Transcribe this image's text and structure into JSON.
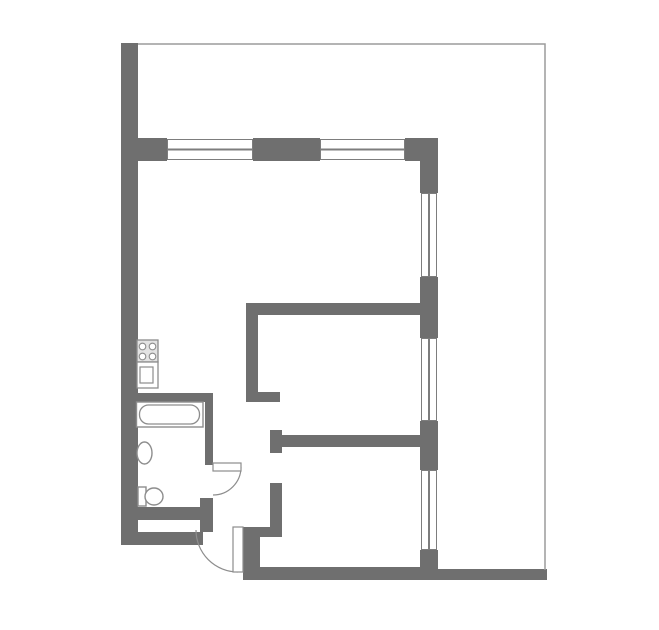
{
  "document": {
    "kind": "apartment-floor-plan",
    "title_text": ""
  },
  "canvas": {
    "width": 659,
    "height": 630
  },
  "colors": {
    "background": "#ffffff",
    "floor": "#ffffff",
    "wall": "#6f6f6f",
    "window_frame": "#7d7d7d",
    "window_line": "#7d7d7d",
    "fixture_outline": "#8d8d8d",
    "stove_fill": "#e3e3e3",
    "site_outline": "#9c9c9c"
  },
  "walls": [
    {
      "name": "wall-left",
      "x": 121,
      "y": 43,
      "w": 17,
      "h": 502
    },
    {
      "name": "wall-top-pier-left",
      "x": 138,
      "y": 138,
      "w": 29,
      "h": 23
    },
    {
      "name": "wall-top-pier-middle",
      "x": 253,
      "y": 138,
      "w": 67,
      "h": 23
    },
    {
      "name": "wall-top-pier-right",
      "x": 405,
      "y": 138,
      "w": 33,
      "h": 23
    },
    {
      "name": "wall-right-seg-1",
      "x": 420,
      "y": 138,
      "w": 18,
      "h": 55
    },
    {
      "name": "wall-right-seg-2",
      "x": 420,
      "y": 277,
      "w": 18,
      "h": 61
    },
    {
      "name": "wall-right-seg-3",
      "x": 420,
      "y": 421,
      "w": 18,
      "h": 49
    },
    {
      "name": "wall-right-seg-4",
      "x": 420,
      "y": 550,
      "w": 18,
      "h": 30
    },
    {
      "name": "wall-living-divider",
      "x": 246,
      "y": 303,
      "w": 174,
      "h": 12
    },
    {
      "name": "wall-hall-vertical",
      "x": 246,
      "y": 303,
      "w": 12,
      "h": 99
    },
    {
      "name": "wall-hall-stub",
      "x": 246,
      "y": 392,
      "w": 34,
      "h": 10
    },
    {
      "name": "wall-bedroom2-top",
      "x": 270,
      "y": 435,
      "w": 150,
      "h": 12
    },
    {
      "name": "wall-bedroom2-top-cap",
      "x": 270,
      "y": 430,
      "w": 12,
      "h": 23
    },
    {
      "name": "wall-bedroom2-left",
      "x": 270,
      "y": 483,
      "w": 12,
      "h": 54
    },
    {
      "name": "wall-entry-jog",
      "x": 243,
      "y": 527,
      "w": 39,
      "h": 10
    },
    {
      "name": "wall-entry-vertical",
      "x": 243,
      "y": 527,
      "w": 17,
      "h": 53
    },
    {
      "name": "wall-bottom-room2",
      "x": 243,
      "y": 567,
      "w": 194,
      "h": 13
    },
    {
      "name": "wall-bottom-strip-right",
      "x": 437,
      "y": 569,
      "w": 110,
      "h": 11
    },
    {
      "name": "wall-bathroom-top",
      "x": 138,
      "y": 393,
      "w": 75,
      "h": 9
    },
    {
      "name": "wall-bathroom-right-upper",
      "x": 205,
      "y": 393,
      "w": 8,
      "h": 72
    },
    {
      "name": "wall-bathroom-right-lower",
      "x": 200,
      "y": 498,
      "w": 13,
      "h": 34
    },
    {
      "name": "wall-bathroom-bottom-inner",
      "x": 138,
      "y": 507,
      "w": 64,
      "h": 13
    },
    {
      "name": "wall-bottom-left",
      "x": 121,
      "y": 532,
      "w": 82,
      "h": 13
    }
  ],
  "windows": [
    {
      "name": "window-top-1",
      "x": 167,
      "y": 139,
      "w": 86,
      "h": 21,
      "orientation": "h"
    },
    {
      "name": "window-top-2",
      "x": 320,
      "y": 139,
      "w": 85,
      "h": 21,
      "orientation": "h"
    },
    {
      "name": "window-right-1",
      "x": 421,
      "y": 193,
      "w": 16,
      "h": 84,
      "orientation": "v"
    },
    {
      "name": "window-right-2",
      "x": 421,
      "y": 338,
      "w": 16,
      "h": 83,
      "orientation": "v"
    },
    {
      "name": "window-right-3",
      "x": 421,
      "y": 470,
      "w": 16,
      "h": 80,
      "orientation": "v"
    }
  ],
  "vector_items": [
    {
      "name": "site-outline",
      "type": "polyline",
      "points": "138,44 545,44 545,570",
      "stroke": "site_outline",
      "stroke_width": 1.5,
      "fill": "none"
    },
    {
      "name": "bathroom-door-arc",
      "type": "path",
      "d": "M 241 467 A 28 28 0 0 1 213 495",
      "stroke": "fixture_outline",
      "stroke_width": 1.2,
      "fill": "none"
    },
    {
      "name": "bathroom-door-leaf",
      "type": "rect",
      "x": 213,
      "y": 463,
      "width": 28,
      "height": 8,
      "stroke": "fixture_outline",
      "stroke_width": 1.2,
      "fill": "#ffffff"
    },
    {
      "name": "entry-door-arc",
      "type": "path",
      "d": "M 196 530 A 42 42 0 0 0 238 572",
      "stroke": "fixture_outline",
      "stroke_width": 1.2,
      "fill": "none"
    },
    {
      "name": "entry-door-leaf",
      "type": "rect",
      "x": 233,
      "y": 527,
      "width": 10,
      "height": 45,
      "stroke": "fixture_outline",
      "stroke_width": 1.2,
      "fill": "#ffffff"
    },
    {
      "name": "bathtub-rim",
      "type": "rect",
      "x": 136.5,
      "y": 402,
      "width": 66.5,
      "height": 25,
      "stroke": "fixture_outline",
      "stroke_width": 1.4,
      "fill": "#ffffff"
    },
    {
      "name": "bathtub-basin",
      "type": "rect",
      "x": 139.5,
      "y": 405,
      "width": 60,
      "height": 19,
      "rx": 9,
      "stroke": "fixture_outline",
      "stroke_width": 1.3,
      "fill": "none"
    },
    {
      "name": "bathroom-sink",
      "type": "ellipse",
      "cx": 144.5,
      "cy": 453,
      "rx": 7.5,
      "ry": 11,
      "stroke": "fixture_outline",
      "stroke_width": 1.4,
      "fill": "#ffffff"
    },
    {
      "name": "toilet-tank",
      "type": "rect",
      "x": 138,
      "y": 487,
      "width": 8,
      "height": 19,
      "stroke": "fixture_outline",
      "stroke_width": 1.4,
      "fill": "#ffffff"
    },
    {
      "name": "toilet-bowl",
      "type": "ellipse",
      "cx": 154,
      "cy": 496.5,
      "rx": 9,
      "ry": 8.5,
      "stroke": "fixture_outline",
      "stroke_width": 1.4,
      "fill": "#ffffff"
    },
    {
      "name": "stove-body",
      "type": "rect",
      "x": 137,
      "y": 340,
      "width": 21,
      "height": 22,
      "stroke": "fixture_outline",
      "stroke_width": 1.3,
      "fill": "stove_fill"
    },
    {
      "name": "stove-burner-1",
      "type": "circle",
      "cx": 142.5,
      "cy": 346.5,
      "r": 3.3,
      "stroke": "fixture_outline",
      "stroke_width": 1.1,
      "fill": "#ffffff"
    },
    {
      "name": "stove-burner-2",
      "type": "circle",
      "cx": 152.5,
      "cy": 346.5,
      "r": 3.3,
      "stroke": "fixture_outline",
      "stroke_width": 1.1,
      "fill": "#ffffff"
    },
    {
      "name": "stove-burner-3",
      "type": "circle",
      "cx": 142.5,
      "cy": 356.5,
      "r": 3.3,
      "stroke": "fixture_outline",
      "stroke_width": 1.1,
      "fill": "#ffffff"
    },
    {
      "name": "stove-burner-4",
      "type": "circle",
      "cx": 152.5,
      "cy": 356.5,
      "r": 3.3,
      "stroke": "fixture_outline",
      "stroke_width": 1.1,
      "fill": "#ffffff"
    },
    {
      "name": "kitchen-sink-body",
      "type": "rect",
      "x": 137,
      "y": 362,
      "width": 21,
      "height": 26,
      "stroke": "fixture_outline",
      "stroke_width": 1.3,
      "fill": "#ffffff"
    },
    {
      "name": "kitchen-sink-basin",
      "type": "rect",
      "x": 140,
      "y": 367,
      "width": 13,
      "height": 16,
      "stroke": "fixture_outline",
      "stroke_width": 1.2,
      "fill": "none"
    }
  ]
}
